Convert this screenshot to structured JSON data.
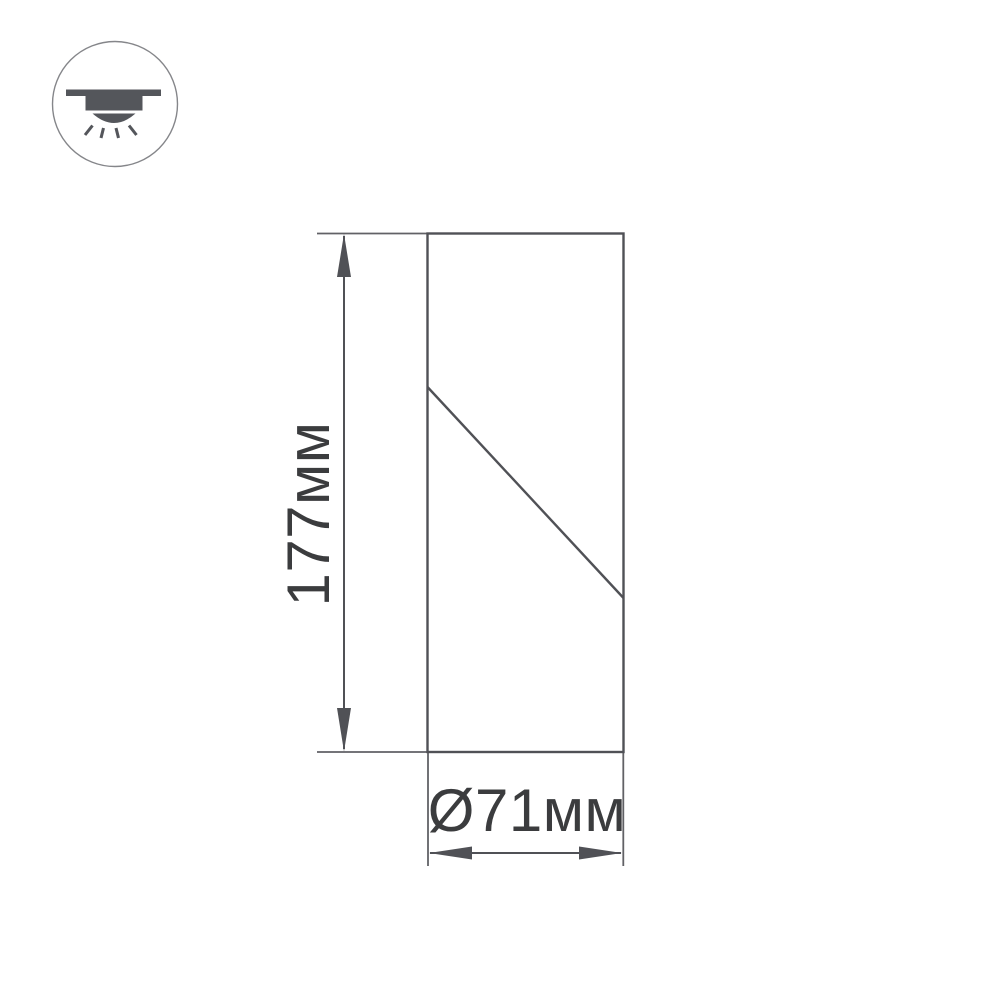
{
  "colors": {
    "bg": "#ffffff",
    "line": "#505156",
    "text": "#3b3c3e",
    "icon": "#54565b",
    "circle": "#85868a"
  },
  "icons": {
    "fixture": "surface-mounted-ceiling-downlight-icon"
  },
  "drawing": {
    "dimensions": {
      "height": {
        "label": "177мм",
        "value_mm": 177
      },
      "diameter": {
        "label": "Ø71мм",
        "value_mm": 71
      }
    }
  }
}
